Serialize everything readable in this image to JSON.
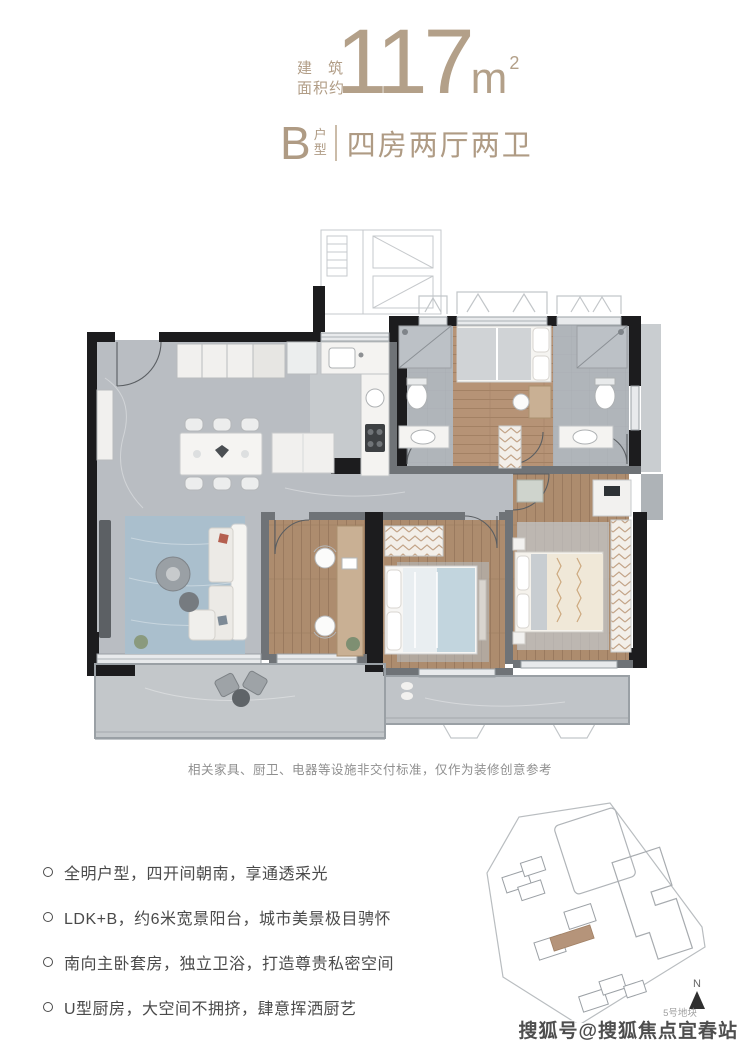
{
  "header": {
    "accent_color": "#b19d86",
    "area_label_line1": "建筑",
    "area_label_line2": "面积约",
    "area_value": "117",
    "area_unit": "m",
    "area_unit_exponent": "2",
    "unit_code": "B",
    "unit_code_suffix": "户型",
    "layout_title": "四房两厅两卫"
  },
  "floorplan": {
    "disclaimer": "相关家具、厨卫、电器等设施非交付标准，仅作为装修创意参考",
    "colors": {
      "wall_black": "#1c1c1e",
      "wall_gray": "#6f7377",
      "floor_marble": "#b9bdc2",
      "floor_tile": "#b0b5ba",
      "floor_wood": "#ad8c6e",
      "floor_balcony": "#c3c7ca",
      "rug_blue": "#aabfcd",
      "bed_blue": "#c2d5de",
      "furniture_white": "#f4f3f1"
    }
  },
  "features": {
    "items": [
      {
        "text": "全明户型，四开间朝南，享通透采光"
      },
      {
        "text": "LDK+B，约6米宽景阳台，城市美景极目骋怀"
      },
      {
        "text": "南向主卧套房，独立卫浴，打造尊贵私密空间"
      },
      {
        "text": "U型厨房，大空间不拥挤，肆意挥洒厨艺"
      }
    ]
  },
  "sitemap": {
    "plot_label": "5号地块",
    "compass_label": "N",
    "highlight_color": "#b5947a"
  },
  "watermark": {
    "text": "搜狐号@搜狐焦点宜春站"
  }
}
